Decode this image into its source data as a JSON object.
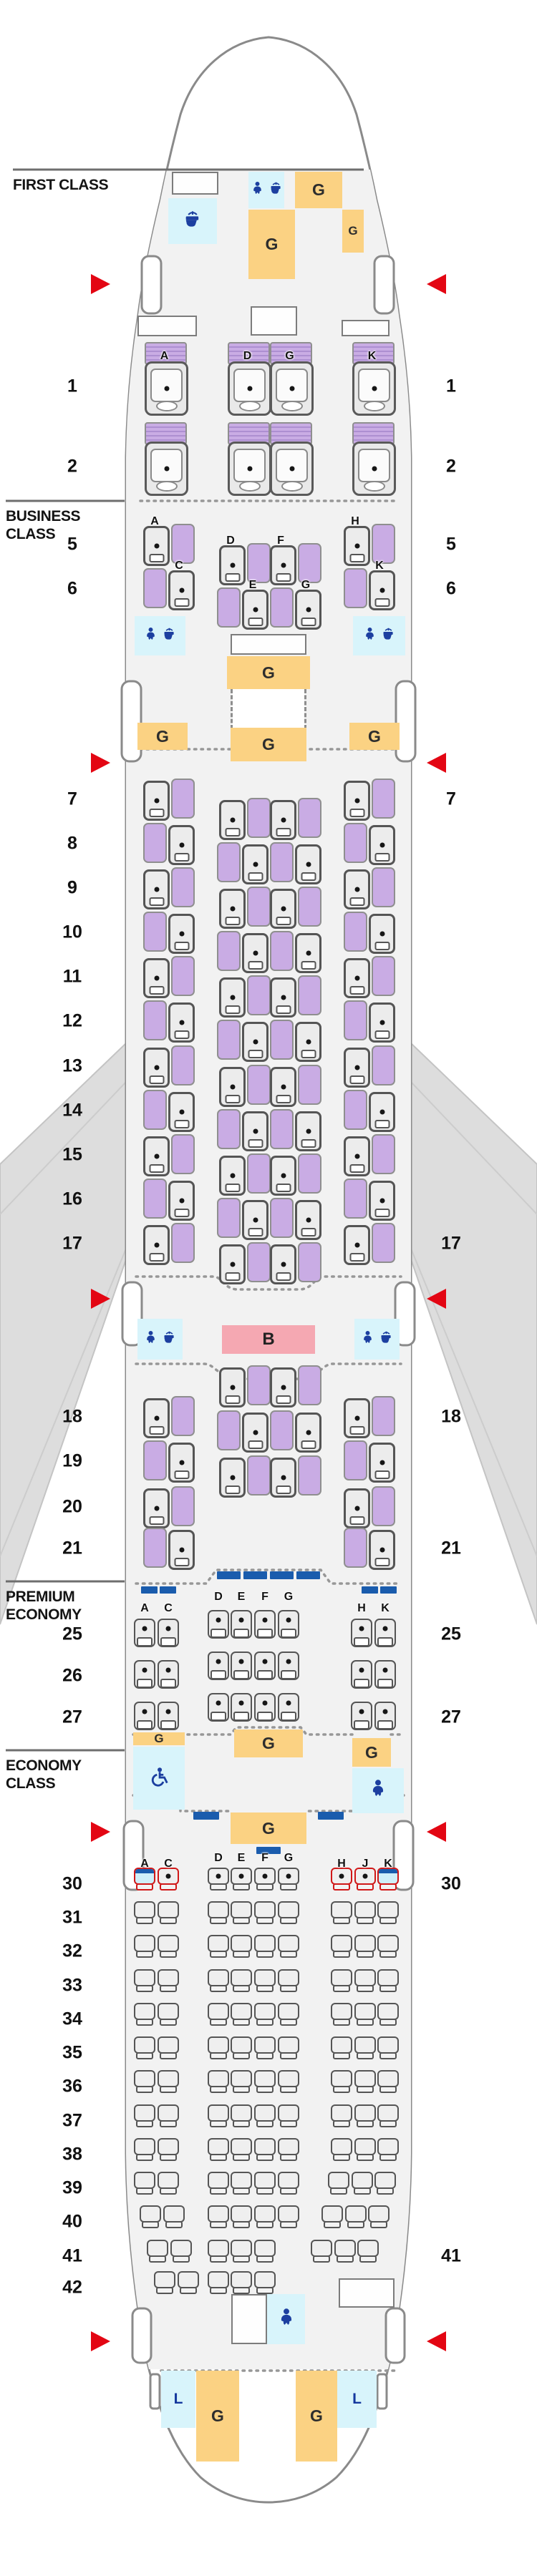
{
  "sections": {
    "first": {
      "line1": "FIRST CLASS",
      "line2": ""
    },
    "business": {
      "line1": "BUSINESS",
      "line2": "CLASS"
    },
    "premium": {
      "line1": "PREMIUM",
      "line2": "ECONOMY"
    },
    "economy": {
      "line1": "ECONOMY",
      "line2": "CLASS"
    }
  },
  "facility_labels": {
    "galley": "G",
    "lavatory": "L",
    "bar": "B"
  },
  "first_class": {
    "rows": [
      "1",
      "2"
    ],
    "letters": [
      "A",
      "D",
      "G",
      "K"
    ]
  },
  "business_class": {
    "rows_forward": [
      "5",
      "6",
      "7",
      "8",
      "9",
      "10",
      "11",
      "12",
      "13",
      "14",
      "15",
      "16",
      "17"
    ],
    "rows_rear": [
      "18",
      "19",
      "20",
      "21"
    ],
    "row5_letters": [
      "A",
      "D",
      "F",
      "H"
    ],
    "row6_letters": [
      "C",
      "E",
      "G",
      "K"
    ]
  },
  "premium_economy": {
    "rows": [
      "25",
      "26",
      "27"
    ],
    "letters_left": [
      "A",
      "C"
    ],
    "letters_center": [
      "D",
      "E",
      "F",
      "G"
    ],
    "letters_right": [
      "H",
      "K"
    ]
  },
  "economy": {
    "rows": [
      "30",
      "31",
      "32",
      "33",
      "34",
      "35",
      "36",
      "37",
      "38",
      "39",
      "40",
      "41",
      "42"
    ],
    "letters_left": [
      "A",
      "C"
    ],
    "letters_center": [
      "D",
      "E",
      "F",
      "G"
    ],
    "letters_right": [
      "H",
      "J",
      "K"
    ],
    "row30_red_seats": [
      "A",
      "C",
      "H",
      "J",
      "K"
    ],
    "row30_bassinet_seats": [
      "A",
      "K"
    ],
    "row30_dot_seats": [
      "C",
      "D",
      "E",
      "F",
      "G",
      "H",
      "J"
    ]
  },
  "row_numbers": {
    "left": [
      "1",
      "2",
      "5",
      "6",
      "7",
      "8",
      "9",
      "10",
      "11",
      "12",
      "13",
      "14",
      "15",
      "16",
      "17",
      "18",
      "19",
      "20",
      "21",
      "25",
      "26",
      "27",
      "30",
      "31",
      "32",
      "33",
      "34",
      "35",
      "36",
      "37",
      "38",
      "39",
      "40",
      "41",
      "42"
    ],
    "right": [
      "1",
      "2",
      "5",
      "6",
      "7",
      "17",
      "18",
      "21",
      "25",
      "27",
      "30",
      "41"
    ]
  },
  "icons": {
    "lavatory": "toilet-icon",
    "baby": "baby-care-icon",
    "wheelchair": "accessible-lavatory-icon",
    "exit": "exit-triangle-icon"
  },
  "colors": {
    "galley": "#FBD283",
    "lavatory": "#D8F4FB",
    "bar": "#F5A8B2",
    "business_seat_purple": "#C9ACE4",
    "exit_red": "#E30613",
    "icon_blue": "#1C3FA0",
    "panel_blue": "#1A5CAD",
    "special_seat_red": "#D01818",
    "interior_gray": "#F2F2F2",
    "wing_gray": "#DDDDDD"
  }
}
